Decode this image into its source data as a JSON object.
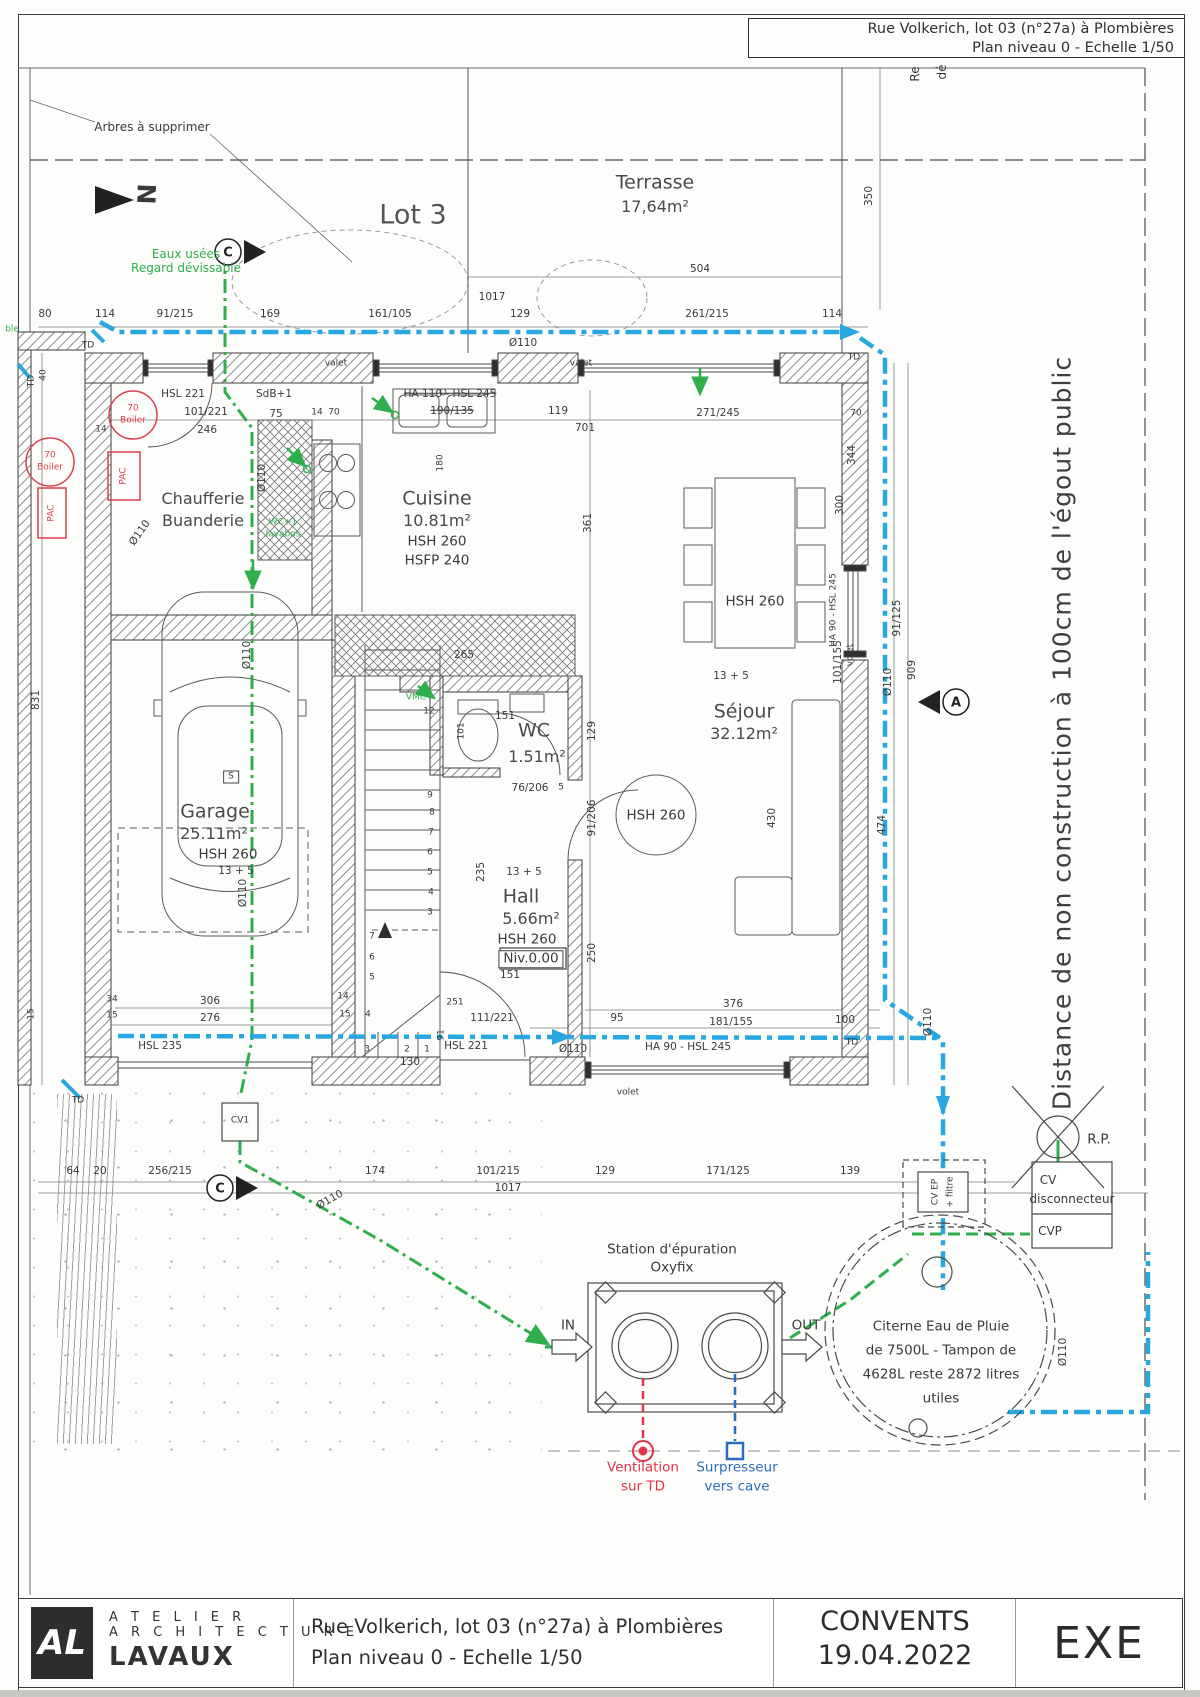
{
  "header": {
    "line1": "Rue Volkerich, lot 03 (n°27a) à Plombières",
    "line2": "Plan niveau 0 - Echelle 1/50"
  },
  "title_block": {
    "logo_monogram": "AL",
    "firm_line1": "A T E L I E R",
    "firm_line2": "A R C H I T E C T U R E",
    "firm_line3": "LAVAUX",
    "project_line1": "Rue Volkerich, lot 03 (n°27a) à Plombières",
    "project_line2": "Plan niveau 0 - Echelle 1/50",
    "client": "CONVENTS",
    "date": "19.04.2022",
    "phase": "EXE"
  },
  "colors": {
    "pipe_green": "#2fae4c",
    "pipe_blue": "#29a7e0",
    "accent_red": "#d8414b",
    "text_blue": "#2b6cc0"
  },
  "labels": [
    {
      "t": "Arbres à supprimer",
      "x": 152,
      "y": 127,
      "c": "n",
      "id": "note-arbres"
    },
    {
      "t": "Lot 3",
      "x": 413,
      "y": 215,
      "c": "lot",
      "id": "lot-label"
    },
    {
      "t": "N",
      "x": 146,
      "y": 194,
      "c": "north",
      "r": 92,
      "id": "north-letter"
    },
    {
      "t": "Eaux usées",
      "x": 186,
      "y": 254,
      "c": "n g"
    },
    {
      "t": "Regard dévissable",
      "x": 186,
      "y": 268,
      "c": "n g"
    },
    {
      "t": "Terrasse",
      "x": 655,
      "y": 183,
      "c": "rm",
      "id": "room-terrasse"
    },
    {
      "t": "17,64m²",
      "x": 655,
      "y": 207,
      "c": "rm2"
    },
    {
      "t": "504",
      "x": 700,
      "y": 269,
      "c": "d"
    },
    {
      "t": "1017",
      "x": 492,
      "y": 297,
      "c": "d"
    },
    {
      "t": "80",
      "x": 45,
      "y": 314,
      "c": "d"
    },
    {
      "t": "114",
      "x": 105,
      "y": 314,
      "c": "d"
    },
    {
      "t": "91/215",
      "x": 175,
      "y": 314,
      "c": "d"
    },
    {
      "t": "169",
      "x": 270,
      "y": 314,
      "c": "d"
    },
    {
      "t": "161/105",
      "x": 390,
      "y": 314,
      "c": "d"
    },
    {
      "t": "129",
      "x": 520,
      "y": 314,
      "c": "d"
    },
    {
      "t": "261/215",
      "x": 707,
      "y": 314,
      "c": "d"
    },
    {
      "t": "114",
      "x": 832,
      "y": 314,
      "c": "d"
    },
    {
      "t": "Ø110",
      "x": 523,
      "y": 343,
      "c": "d"
    },
    {
      "t": "Re",
      "x": 915,
      "y": 74,
      "c": "n",
      "r": -90
    },
    {
      "t": "dé",
      "x": 942,
      "y": 72,
      "c": "n",
      "r": -90
    },
    {
      "t": "C",
      "x": 228,
      "y": 253,
      "c": "mk",
      "id": "section-c-top"
    },
    {
      "t": "C",
      "x": 220,
      "y": 1189,
      "c": "mk",
      "id": "section-c-bottom"
    },
    {
      "t": "A",
      "x": 956,
      "y": 703,
      "c": "mk",
      "id": "section-a"
    },
    {
      "t": "TD",
      "x": 88,
      "y": 346,
      "c": "s"
    },
    {
      "t": "TD",
      "x": 32,
      "y": 381,
      "c": "s",
      "r": -90
    },
    {
      "t": "TD",
      "x": 854,
      "y": 358,
      "c": "s"
    },
    {
      "t": "TD",
      "x": 78,
      "y": 1101,
      "c": "s"
    },
    {
      "t": "TD",
      "x": 852,
      "y": 1043,
      "c": "s"
    },
    {
      "t": "ble",
      "x": 12,
      "y": 330,
      "c": "s g"
    },
    {
      "t": "350",
      "x": 869,
      "y": 196,
      "c": "d",
      "r": -90
    },
    {
      "t": "valet",
      "x": 336,
      "y": 364,
      "c": "s"
    },
    {
      "t": "valet",
      "x": 581,
      "y": 364,
      "c": "s"
    },
    {
      "t": "HSL 221",
      "x": 183,
      "y": 394,
      "c": "d"
    },
    {
      "t": "SdB+1",
      "x": 274,
      "y": 394,
      "c": "d"
    },
    {
      "t": "101/221",
      "x": 206,
      "y": 412,
      "c": "d"
    },
    {
      "t": "246",
      "x": 207,
      "y": 430,
      "c": "d"
    },
    {
      "t": "75",
      "x": 276,
      "y": 414,
      "c": "d"
    },
    {
      "t": "14",
      "x": 317,
      "y": 413,
      "c": "s"
    },
    {
      "t": "70",
      "x": 334,
      "y": 413,
      "c": "s"
    },
    {
      "t": "14",
      "x": 101,
      "y": 430,
      "c": "s"
    },
    {
      "t": "70",
      "x": 133,
      "y": 409,
      "c": "rd s"
    },
    {
      "t": "Boiler",
      "x": 133,
      "y": 421,
      "c": "rd s"
    },
    {
      "t": "70",
      "x": 50,
      "y": 456,
      "c": "rd s"
    },
    {
      "t": "Boiler",
      "x": 50,
      "y": 468,
      "c": "rd s"
    },
    {
      "t": "PAC",
      "x": 124,
      "y": 476,
      "c": "rd s",
      "r": -90
    },
    {
      "t": "PAC",
      "x": 52,
      "y": 513,
      "c": "rd s",
      "r": -90
    },
    {
      "t": "Chaufferie",
      "x": 203,
      "y": 499,
      "c": "rm2",
      "id": "room-chaufferie"
    },
    {
      "t": "Buanderie",
      "x": 203,
      "y": 521,
      "c": "rm2"
    },
    {
      "t": "WC+1",
      "x": 283,
      "y": 523,
      "c": "s g"
    },
    {
      "t": "lavabos",
      "x": 283,
      "y": 535,
      "c": "s g"
    },
    {
      "t": "Ø110",
      "x": 140,
      "y": 533,
      "c": "d",
      "r": -55
    },
    {
      "t": "Ø110",
      "x": 262,
      "y": 478,
      "c": "d",
      "r": -90
    },
    {
      "t": "HA 110 - HSL 245",
      "x": 450,
      "y": 394,
      "c": "d st"
    },
    {
      "t": "190/135",
      "x": 452,
      "y": 411,
      "c": "d st"
    },
    {
      "t": "119",
      "x": 558,
      "y": 411,
      "c": "d"
    },
    {
      "t": "701",
      "x": 585,
      "y": 428,
      "c": "d"
    },
    {
      "t": "180",
      "x": 441,
      "y": 463,
      "c": "s",
      "r": -90
    },
    {
      "t": "Cuisine",
      "x": 437,
      "y": 499,
      "c": "rm",
      "id": "room-cuisine"
    },
    {
      "t": "10.81m²",
      "x": 437,
      "y": 521,
      "c": "rm2"
    },
    {
      "t": "HSH 260",
      "x": 437,
      "y": 542,
      "c": "m"
    },
    {
      "t": "HSFP 240",
      "x": 437,
      "y": 561,
      "c": "m"
    },
    {
      "t": "265",
      "x": 464,
      "y": 655,
      "c": "d"
    },
    {
      "t": "361",
      "x": 588,
      "y": 523,
      "c": "d",
      "r": -90
    },
    {
      "t": "271/245",
      "x": 718,
      "y": 413,
      "c": "d"
    },
    {
      "t": "70",
      "x": 856,
      "y": 414,
      "c": "s"
    },
    {
      "t": "HSH 260",
      "x": 755,
      "y": 602,
      "c": "m"
    },
    {
      "t": "300",
      "x": 840,
      "y": 505,
      "c": "d",
      "r": -90
    },
    {
      "t": "101/155",
      "x": 838,
      "y": 662,
      "c": "d",
      "r": -90
    },
    {
      "t": "13 + 5",
      "x": 731,
      "y": 676,
      "c": "d"
    },
    {
      "t": "Séjour",
      "x": 744,
      "y": 712,
      "c": "rm",
      "id": "room-sejour"
    },
    {
      "t": "32.12m²",
      "x": 744,
      "y": 734,
      "c": "rm2"
    },
    {
      "t": "HSH 260",
      "x": 656,
      "y": 816,
      "c": "m"
    },
    {
      "t": "430",
      "x": 772,
      "y": 818,
      "c": "d",
      "r": -90
    },
    {
      "t": "HA 90 - HSL 245",
      "x": 834,
      "y": 610,
      "c": "s",
      "r": -90
    },
    {
      "t": "volet",
      "x": 851,
      "y": 655,
      "c": "s",
      "r": -90
    },
    {
      "t": "129",
      "x": 592,
      "y": 731,
      "c": "d",
      "r": -90
    },
    {
      "t": "91/206",
      "x": 592,
      "y": 818,
      "c": "d",
      "r": -90
    },
    {
      "t": "250",
      "x": 592,
      "y": 953,
      "c": "d",
      "r": -90
    },
    {
      "t": "344",
      "x": 852,
      "y": 455,
      "c": "d",
      "r": -90
    },
    {
      "t": "91/125",
      "x": 897,
      "y": 618,
      "c": "d",
      "r": -90
    },
    {
      "t": "909",
      "x": 912,
      "y": 670,
      "c": "d",
      "r": -90
    },
    {
      "t": "474",
      "x": 882,
      "y": 825,
      "c": "d",
      "r": -90
    },
    {
      "t": "Ø110",
      "x": 888,
      "y": 682,
      "c": "d",
      "r": -90
    },
    {
      "t": "Ø110",
      "x": 928,
      "y": 1022,
      "c": "d",
      "r": -90
    },
    {
      "t": "Distance de non construction à 100cm de l'égout public",
      "x": 1062,
      "y": 733,
      "c": "big",
      "r": -90,
      "id": "sewer-setback-note"
    },
    {
      "t": "VMC",
      "x": 416,
      "y": 698,
      "c": "s g"
    },
    {
      "t": "12",
      "x": 429,
      "y": 712,
      "c": "s"
    },
    {
      "t": "151",
      "x": 505,
      "y": 716,
      "c": "d"
    },
    {
      "t": "101",
      "x": 462,
      "y": 731,
      "c": "s",
      "r": -90
    },
    {
      "t": "WC",
      "x": 534,
      "y": 731,
      "c": "rm",
      "id": "room-wc"
    },
    {
      "t": "1.51m²",
      "x": 537,
      "y": 757,
      "c": "rm2"
    },
    {
      "t": "76/206",
      "x": 530,
      "y": 788,
      "c": "d"
    },
    {
      "t": "5",
      "x": 561,
      "y": 788,
      "c": "s"
    },
    {
      "t": "235",
      "x": 481,
      "y": 872,
      "c": "d",
      "r": -90
    },
    {
      "t": "13 + 5",
      "x": 524,
      "y": 872,
      "c": "d"
    },
    {
      "t": "Hall",
      "x": 521,
      "y": 897,
      "c": "rm",
      "id": "room-hall"
    },
    {
      "t": "5.66m²",
      "x": 531,
      "y": 919,
      "c": "rm2"
    },
    {
      "t": "HSH 260",
      "x": 527,
      "y": 940,
      "c": "m"
    },
    {
      "t": "Niv.0.00",
      "x": 531,
      "y": 959,
      "c": "m bx",
      "id": "level-datum"
    },
    {
      "t": "151",
      "x": 510,
      "y": 975,
      "c": "d"
    },
    {
      "t": "9",
      "x": 430,
      "y": 796,
      "c": "s"
    },
    {
      "t": "8",
      "x": 432,
      "y": 813,
      "c": "s"
    },
    {
      "t": "7",
      "x": 431,
      "y": 833,
      "c": "s"
    },
    {
      "t": "6",
      "x": 430,
      "y": 853,
      "c": "s"
    },
    {
      "t": "5",
      "x": 430,
      "y": 873,
      "c": "s"
    },
    {
      "t": "4",
      "x": 431,
      "y": 893,
      "c": "s"
    },
    {
      "t": "3",
      "x": 430,
      "y": 913,
      "c": "s"
    },
    {
      "t": "7",
      "x": 372,
      "y": 937,
      "c": "s"
    },
    {
      "t": "6",
      "x": 372,
      "y": 958,
      "c": "s"
    },
    {
      "t": "5",
      "x": 372,
      "y": 978,
      "c": "s"
    },
    {
      "t": "3",
      "x": 367,
      "y": 1050,
      "c": "s"
    },
    {
      "t": "2",
      "x": 407,
      "y": 1050,
      "c": "s"
    },
    {
      "t": "1",
      "x": 427,
      "y": 1050,
      "c": "s"
    },
    {
      "t": "91",
      "x": 442,
      "y": 1035,
      "c": "s",
      "r": -90
    },
    {
      "t": "111/221",
      "x": 492,
      "y": 1018,
      "c": "d"
    },
    {
      "t": "130",
      "x": 410,
      "y": 1062,
      "c": "d"
    },
    {
      "t": "15",
      "x": 345,
      "y": 1015,
      "c": "s"
    },
    {
      "t": "4",
      "x": 368,
      "y": 1015,
      "c": "s"
    },
    {
      "t": "14",
      "x": 343,
      "y": 997,
      "c": "s"
    },
    {
      "t": "251",
      "x": 455,
      "y": 1003,
      "c": "s"
    },
    {
      "t": "S",
      "x": 231,
      "y": 777,
      "c": "s bx"
    },
    {
      "t": "Garage",
      "x": 215,
      "y": 812,
      "c": "rm",
      "id": "room-garage"
    },
    {
      "t": "25.11m²",
      "x": 214,
      "y": 834,
      "c": "rm2"
    },
    {
      "t": "HSH 260",
      "x": 228,
      "y": 855,
      "c": "m"
    },
    {
      "t": "13 + 5",
      "x": 236,
      "y": 871,
      "c": "d"
    },
    {
      "t": "Ø110",
      "x": 247,
      "y": 655,
      "c": "d",
      "r": -90
    },
    {
      "t": "Ø110",
      "x": 243,
      "y": 893,
      "c": "d",
      "r": -90
    },
    {
      "t": "306",
      "x": 210,
      "y": 1001,
      "c": "d"
    },
    {
      "t": "276",
      "x": 210,
      "y": 1018,
      "c": "d"
    },
    {
      "t": "34",
      "x": 112,
      "y": 1000,
      "c": "s"
    },
    {
      "t": "15",
      "x": 112,
      "y": 1016,
      "c": "s"
    },
    {
      "t": "HSL 235",
      "x": 160,
      "y": 1046,
      "c": "d"
    },
    {
      "t": "831",
      "x": 36,
      "y": 700,
      "c": "d",
      "r": -90
    },
    {
      "t": "40",
      "x": 44,
      "y": 375,
      "c": "s",
      "r": -90
    },
    {
      "t": "15",
      "x": 32,
      "y": 1014,
      "c": "s",
      "r": -90
    },
    {
      "t": "HSL 221",
      "x": 466,
      "y": 1046,
      "c": "d"
    },
    {
      "t": "HA 90 - HSL 245",
      "x": 688,
      "y": 1047,
      "c": "d"
    },
    {
      "t": "95",
      "x": 617,
      "y": 1018,
      "c": "d"
    },
    {
      "t": "376",
      "x": 733,
      "y": 1004,
      "c": "d"
    },
    {
      "t": "181/155",
      "x": 731,
      "y": 1022,
      "c": "d"
    },
    {
      "t": "100",
      "x": 845,
      "y": 1020,
      "c": "d"
    },
    {
      "t": "volet",
      "x": 628,
      "y": 1093,
      "c": "s"
    },
    {
      "t": "Ø110",
      "x": 573,
      "y": 1049,
      "c": "d"
    },
    {
      "t": "64",
      "x": 73,
      "y": 1171,
      "c": "d"
    },
    {
      "t": "20",
      "x": 100,
      "y": 1171,
      "c": "d"
    },
    {
      "t": "256/215",
      "x": 170,
      "y": 1171,
      "c": "d"
    },
    {
      "t": "174",
      "x": 375,
      "y": 1171,
      "c": "d"
    },
    {
      "t": "101/215",
      "x": 498,
      "y": 1171,
      "c": "d"
    },
    {
      "t": "129",
      "x": 605,
      "y": 1171,
      "c": "d"
    },
    {
      "t": "171/125",
      "x": 728,
      "y": 1171,
      "c": "d"
    },
    {
      "t": "139",
      "x": 850,
      "y": 1171,
      "c": "d"
    },
    {
      "t": "1017",
      "x": 508,
      "y": 1188,
      "c": "d"
    },
    {
      "t": "CV1",
      "x": 240,
      "y": 1121,
      "c": "s",
      "id": "cv1-box-label"
    },
    {
      "t": "Ø110",
      "x": 330,
      "y": 1200,
      "c": "d",
      "r": -29
    },
    {
      "t": "Station d'épuration",
      "x": 672,
      "y": 1250,
      "c": "m",
      "id": "station-label"
    },
    {
      "t": "Oxyfix",
      "x": 672,
      "y": 1268,
      "c": "m"
    },
    {
      "t": "IN",
      "x": 568,
      "y": 1326,
      "c": "m",
      "id": "station-in"
    },
    {
      "t": "OUT",
      "x": 806,
      "y": 1326,
      "c": "m",
      "id": "station-out"
    },
    {
      "t": "Ventilation",
      "x": 643,
      "y": 1468,
      "c": "m rd2",
      "id": "vent-label"
    },
    {
      "t": "sur TD",
      "x": 643,
      "y": 1487,
      "c": "m rd2"
    },
    {
      "t": "Surpresseur",
      "x": 737,
      "y": 1468,
      "c": "m bl",
      "id": "surpresseur-label"
    },
    {
      "t": "vers cave",
      "x": 737,
      "y": 1487,
      "c": "m bl"
    },
    {
      "t": "Citerne Eau de Pluie",
      "x": 941,
      "y": 1327,
      "c": "m",
      "id": "citerne-label"
    },
    {
      "t": "de 7500L - Tampon de",
      "x": 941,
      "y": 1351,
      "c": "m"
    },
    {
      "t": "4628L reste 2872 litres",
      "x": 941,
      "y": 1375,
      "c": "m"
    },
    {
      "t": "utiles",
      "x": 941,
      "y": 1399,
      "c": "m"
    },
    {
      "t": "CV EP",
      "x": 936,
      "y": 1192,
      "c": "s",
      "r": -90
    },
    {
      "t": "+ filtre",
      "x": 951,
      "y": 1192,
      "c": "s",
      "r": -90
    },
    {
      "t": "CV",
      "x": 1048,
      "y": 1180,
      "c": "n"
    },
    {
      "t": "disconnecteur",
      "x": 1072,
      "y": 1199,
      "c": "n"
    },
    {
      "t": "CVP",
      "x": 1050,
      "y": 1231,
      "c": "n"
    },
    {
      "t": "R.P.",
      "x": 1099,
      "y": 1140,
      "c": "m",
      "id": "rp-label"
    },
    {
      "t": "Ø110",
      "x": 1063,
      "y": 1352,
      "c": "d",
      "r": -90
    }
  ]
}
